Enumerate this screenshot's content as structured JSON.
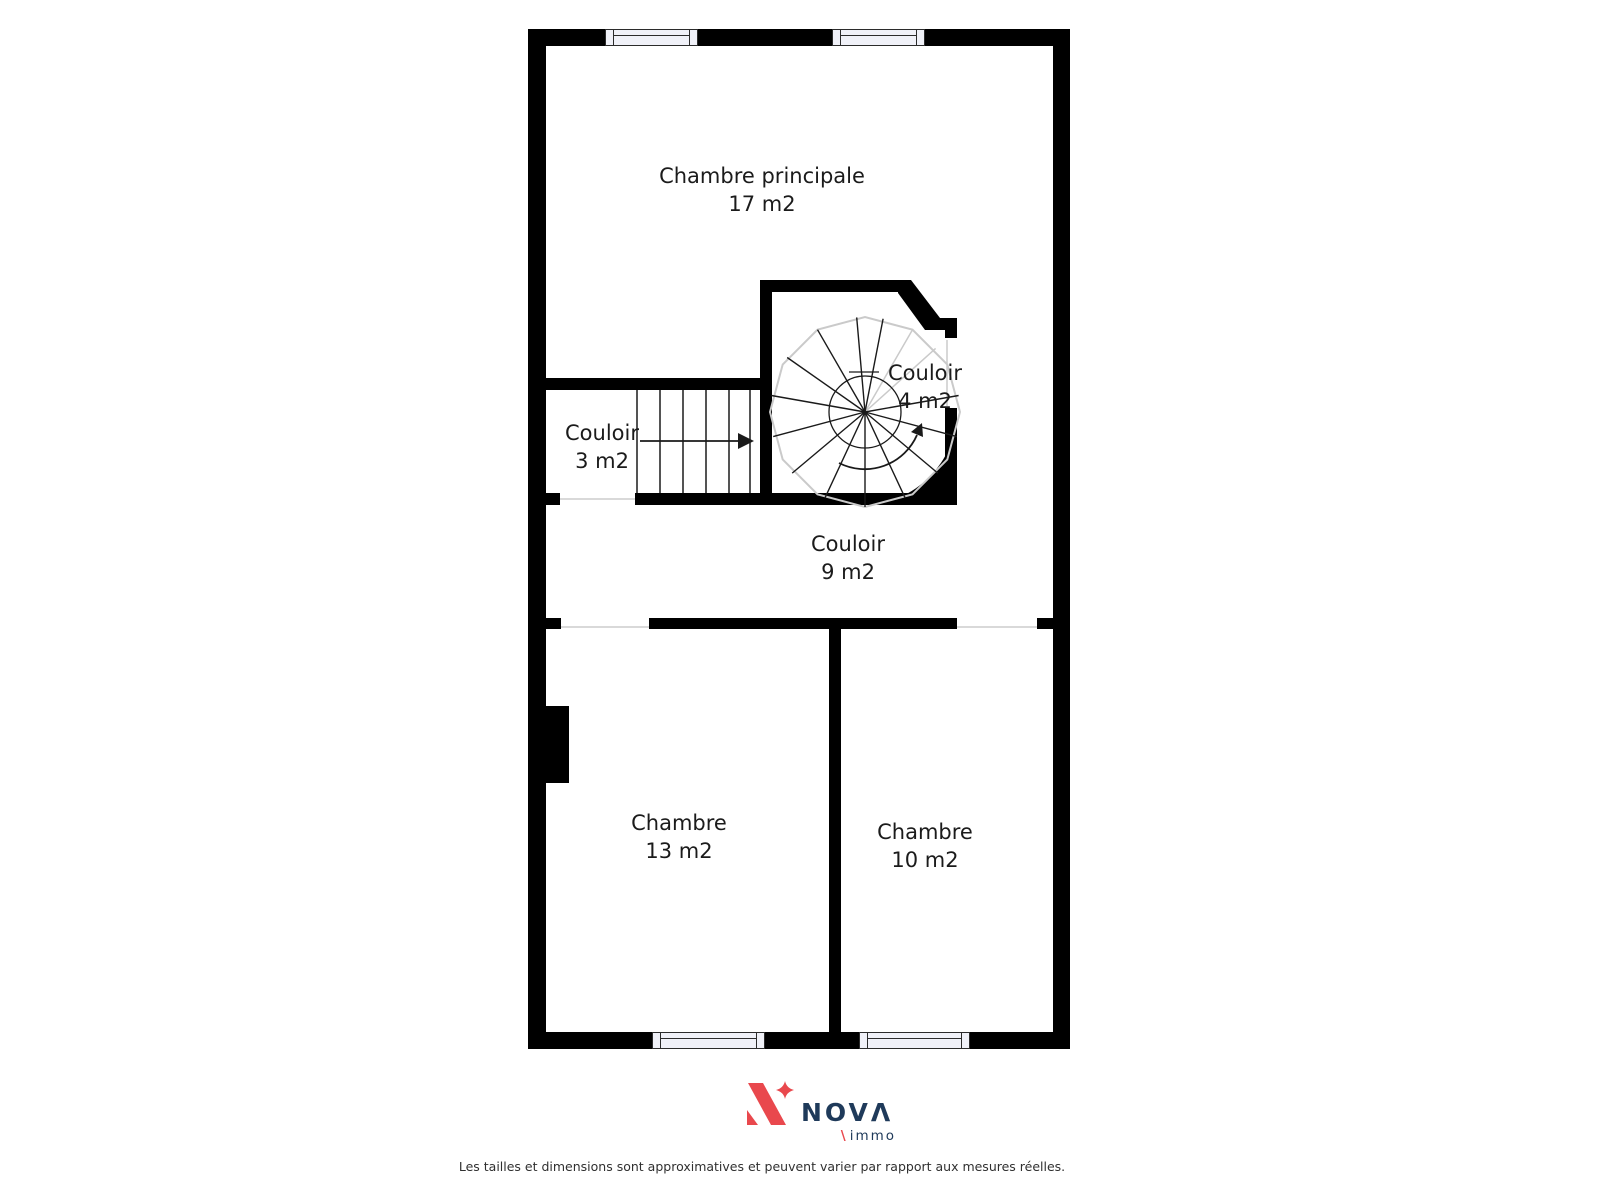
{
  "floorplan": {
    "rooms": [
      {
        "name": "Chambre principale",
        "area": "17 m2"
      },
      {
        "name": "Couloir",
        "area": "3 m2"
      },
      {
        "name": "Couloir",
        "area": "4 m2"
      },
      {
        "name": "Couloir",
        "area": "9 m2"
      },
      {
        "name": "Chambre",
        "area": "13 m2"
      },
      {
        "name": "Chambre",
        "area": "10 m2"
      }
    ],
    "wall_color": "#000000",
    "window_fill": "#f0f1f8"
  },
  "branding": {
    "brand_main": "NOV",
    "brand_last": "Λ",
    "brand_sub": "immo",
    "slash": "\\",
    "accent_red": "#e9484d",
    "navy": "#1f3a5a"
  },
  "footer": {
    "disclaimer": "Les tailles et dimensions sont approximatives et peuvent varier par rapport aux mesures réelles."
  }
}
